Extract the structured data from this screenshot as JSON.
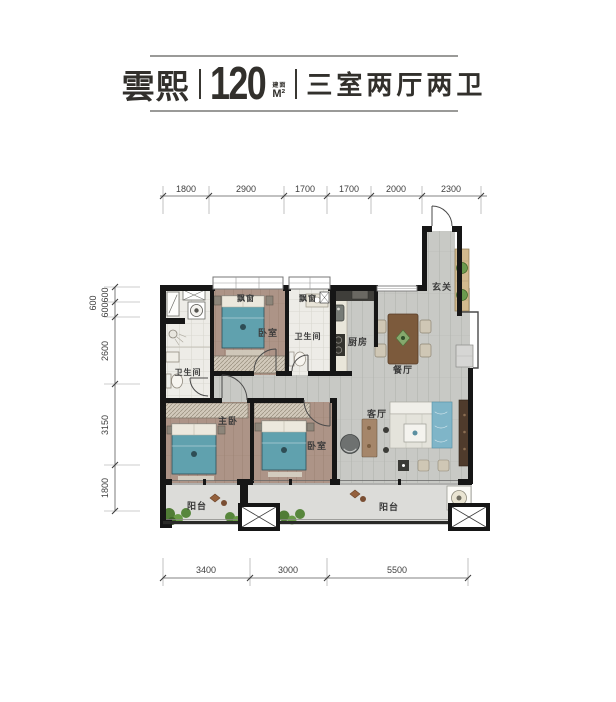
{
  "header": {
    "name": "雲熙",
    "area_value": "120",
    "area_prefix": "建面",
    "area_unit": "M²",
    "layout": "三室两厅两卫"
  },
  "dimensions": {
    "top": [
      "1800",
      "2900",
      "1700",
      "1700",
      "2000",
      "2300"
    ],
    "left": [
      "600",
      "600",
      "2600",
      "3150",
      "1800"
    ],
    "left_outer": "600",
    "bottom": [
      "3400",
      "3000",
      "5500"
    ]
  },
  "rooms": {
    "bay_window_top": "飘窗",
    "bay_window_mid": "飘窗",
    "bedroom_top": "卧室",
    "bathroom_top": "卫生间",
    "kitchen": "厨房",
    "entry": "玄关",
    "dining": "餐厅",
    "bathroom_left": "卫生间",
    "master_bedroom": "主卧",
    "bedroom_mid": "卧室",
    "living": "客厅",
    "balcony_left": "阳台",
    "balcony_right": "阳台"
  },
  "colors": {
    "wall": "#161616",
    "wood_floor": "#ad9487",
    "gray_floor": "#c8c9c5",
    "bed": "#60a1ae",
    "plant": "#5c8f46",
    "title_text": "#32302c"
  }
}
